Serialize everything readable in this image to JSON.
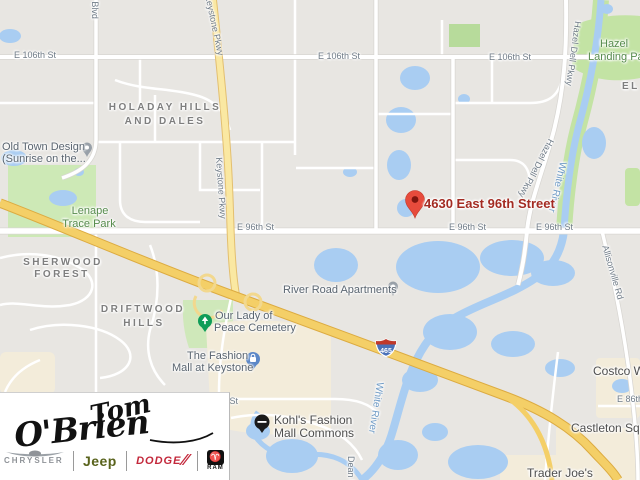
{
  "streets": {
    "e106_a": "E 106th St",
    "e106_b": "E 106th St",
    "e106_c": "E 106th St",
    "e96_a": "E 96th St",
    "e96_b": "E 96th St",
    "e96_c": "E 96th St",
    "e86": "E 86th St",
    "partial_n_st": "n St",
    "westfield": "Westfield Blvd",
    "keystone_a": "Keystone Pkwy",
    "keystone_b": "Keystone Pkwy",
    "hazel_dell_a": "Hazel Dell Pkwy",
    "hazel_dell_b": "Hazel Dell Pkwy",
    "allisonville": "Allisonville Rd",
    "dean": "Dean Rd"
  },
  "water": {
    "white_river_a": "White River",
    "white_river_b": "White River"
  },
  "neighborhoods": {
    "holaday_line1": "HOLADAY HILLS",
    "holaday_line2": "AND DALES",
    "sherwood_line1": "SHERWOOD",
    "sherwood_line2": "FOREST",
    "driftwood_line1": "DRIFTWOOD",
    "driftwood_line2": "HILLS",
    "el_partial": "EL"
  },
  "parks": {
    "lenape_line1": "Lenape",
    "lenape_line2": "Trace Park",
    "hazel_landing_line1": "Hazel",
    "hazel_landing_line2": "Landing Park"
  },
  "pois": {
    "old_town_line1": "Old Town Design",
    "old_town_line2": "(Sunrise on the...",
    "river_road_apartments": "River Road Apartments",
    "cemetery_line1": "Our Lady of",
    "cemetery_line2": "Peace Cemetery",
    "fashion_mall_line1": "The Fashion",
    "fashion_mall_line2": "Mall at Keystone",
    "kohls_line1": "Kohl's Fashion",
    "kohls_line2": "Mall Commons",
    "castleton": "Castleton Square",
    "costco": "Costco Wholesale",
    "trader_joes": "Trader Joe's"
  },
  "marker": {
    "address": "4630 East 96th Street"
  },
  "shield": {
    "route": "465"
  },
  "logo": {
    "first": "Tom",
    "last": "O'Brien",
    "brand_chrysler": "CHRYSLER",
    "brand_jeep": "Jeep",
    "brand_dodge": "DODGE",
    "brand_ram": "RAM"
  },
  "colors": {
    "land": "#e8e6e2",
    "water": "#a9cdf2",
    "park_green": "#cde9b6",
    "commercial": "#f3ecda",
    "highway_yellow": "#f4cf67",
    "parkway_yellow": "#fae8a2",
    "marker_red": "#e74b3c",
    "address_red": "#a32b22",
    "jeep_green": "#59631c",
    "dodge_red": "#c3283b"
  }
}
